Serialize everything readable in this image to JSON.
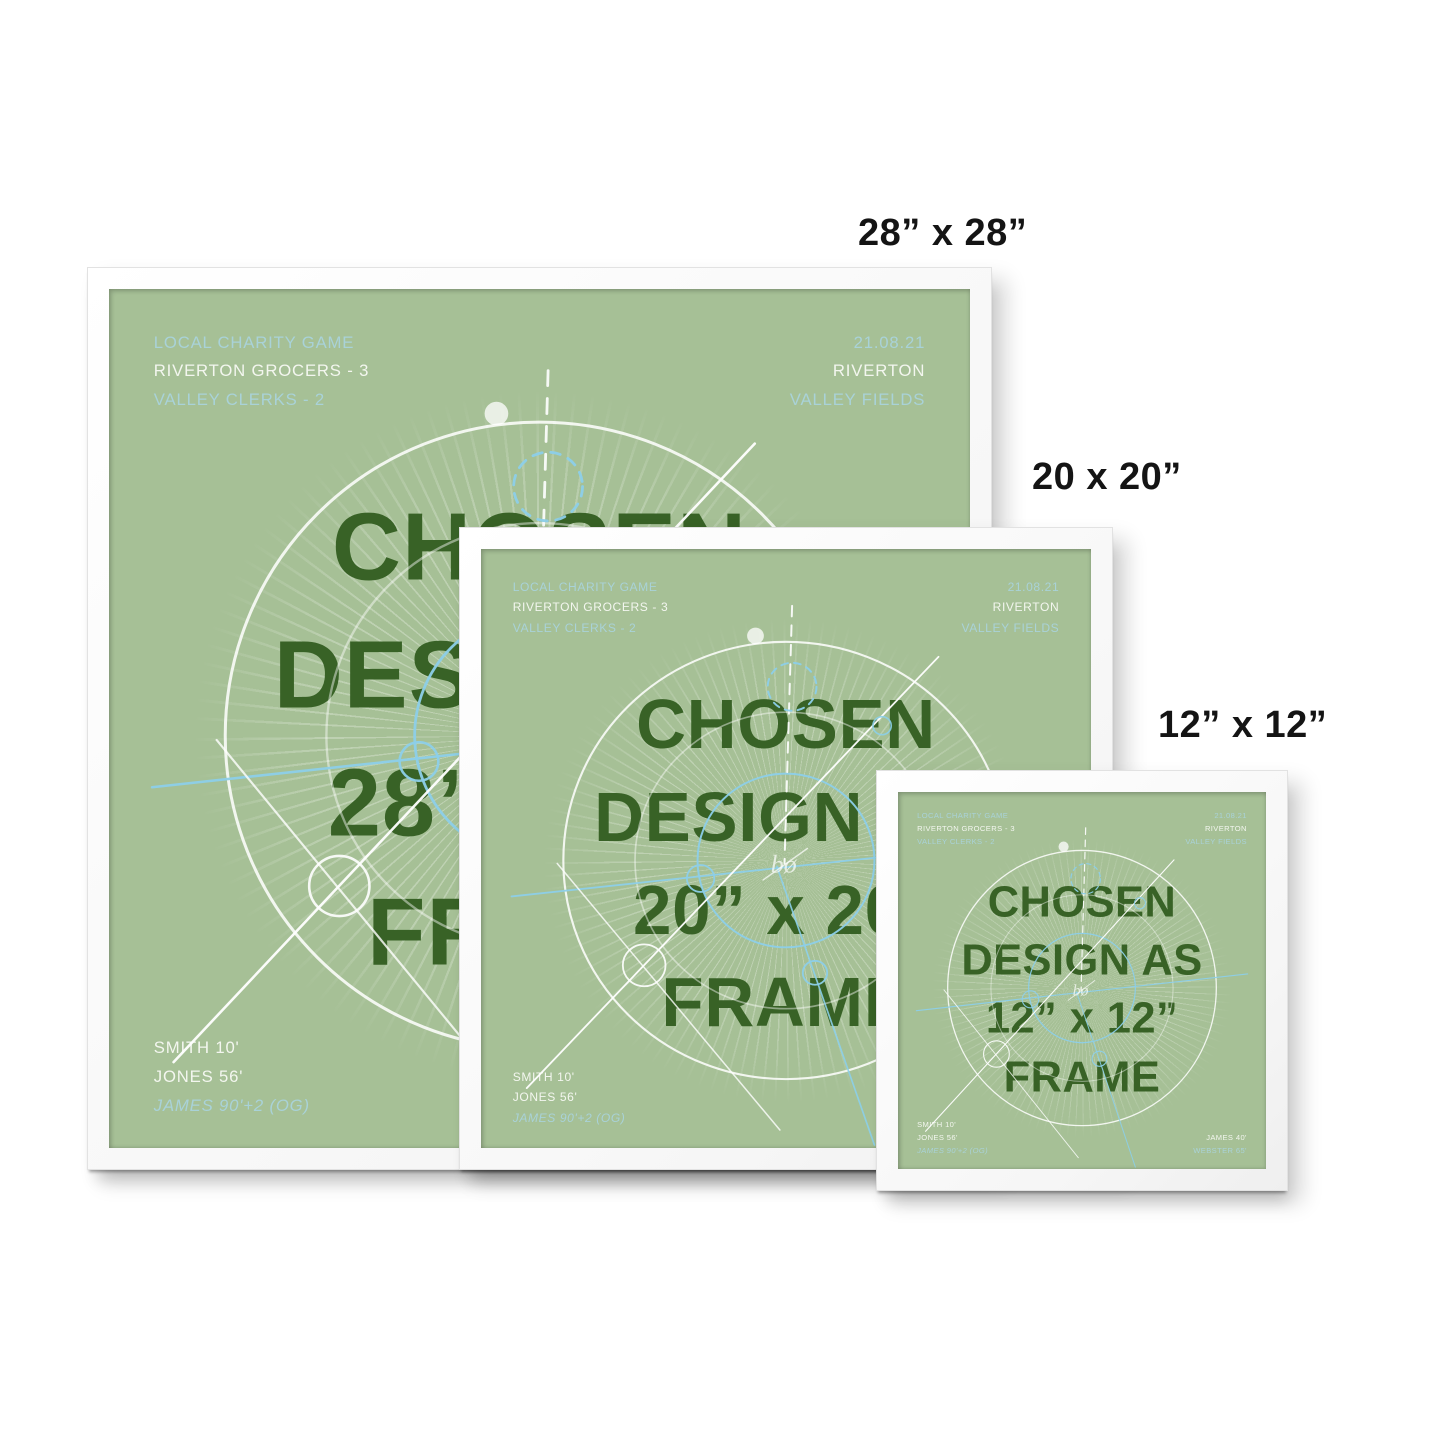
{
  "page": {
    "background": "#ffffff",
    "description_colors": {
      "poster_green": "#a6c096",
      "heading_green": "#386226",
      "accent_teal": "#a9d2d8",
      "text_white": "#f3f6ef",
      "decor_blue": "#8ccfe9",
      "frame_white": "#f8f8f8",
      "label_black": "#141414"
    }
  },
  "poster": {
    "top_left": {
      "line1": "LOCAL CHARITY GAME",
      "line2": "RIVERTON GROCERS - 3",
      "line3": "VALLEY CLERKS - 2"
    },
    "top_right": {
      "line1": "21.08.21",
      "line2": "RIVERTON",
      "line3": "VALLEY FIELDS"
    },
    "bottom_left": {
      "line1": "SMITH 10'",
      "line2": "JONES 56'",
      "line3": "JAMES 90'+2 (OG)"
    },
    "bottom_right": {
      "line1": "JAMES 40'",
      "line2": "WEBSTER 65'"
    },
    "heading": {
      "line1": "CHOSEN",
      "line2": "DESIGN AS",
      "line4": "FRAME"
    },
    "logo_mark": "bø"
  },
  "frames": [
    {
      "label": "28” x 28”",
      "center_size": "28” x 28”"
    },
    {
      "label": "20 x 20”",
      "center_size": "20” x 20”"
    },
    {
      "label": "12” x 12”",
      "center_size": "12” x 12”"
    }
  ]
}
